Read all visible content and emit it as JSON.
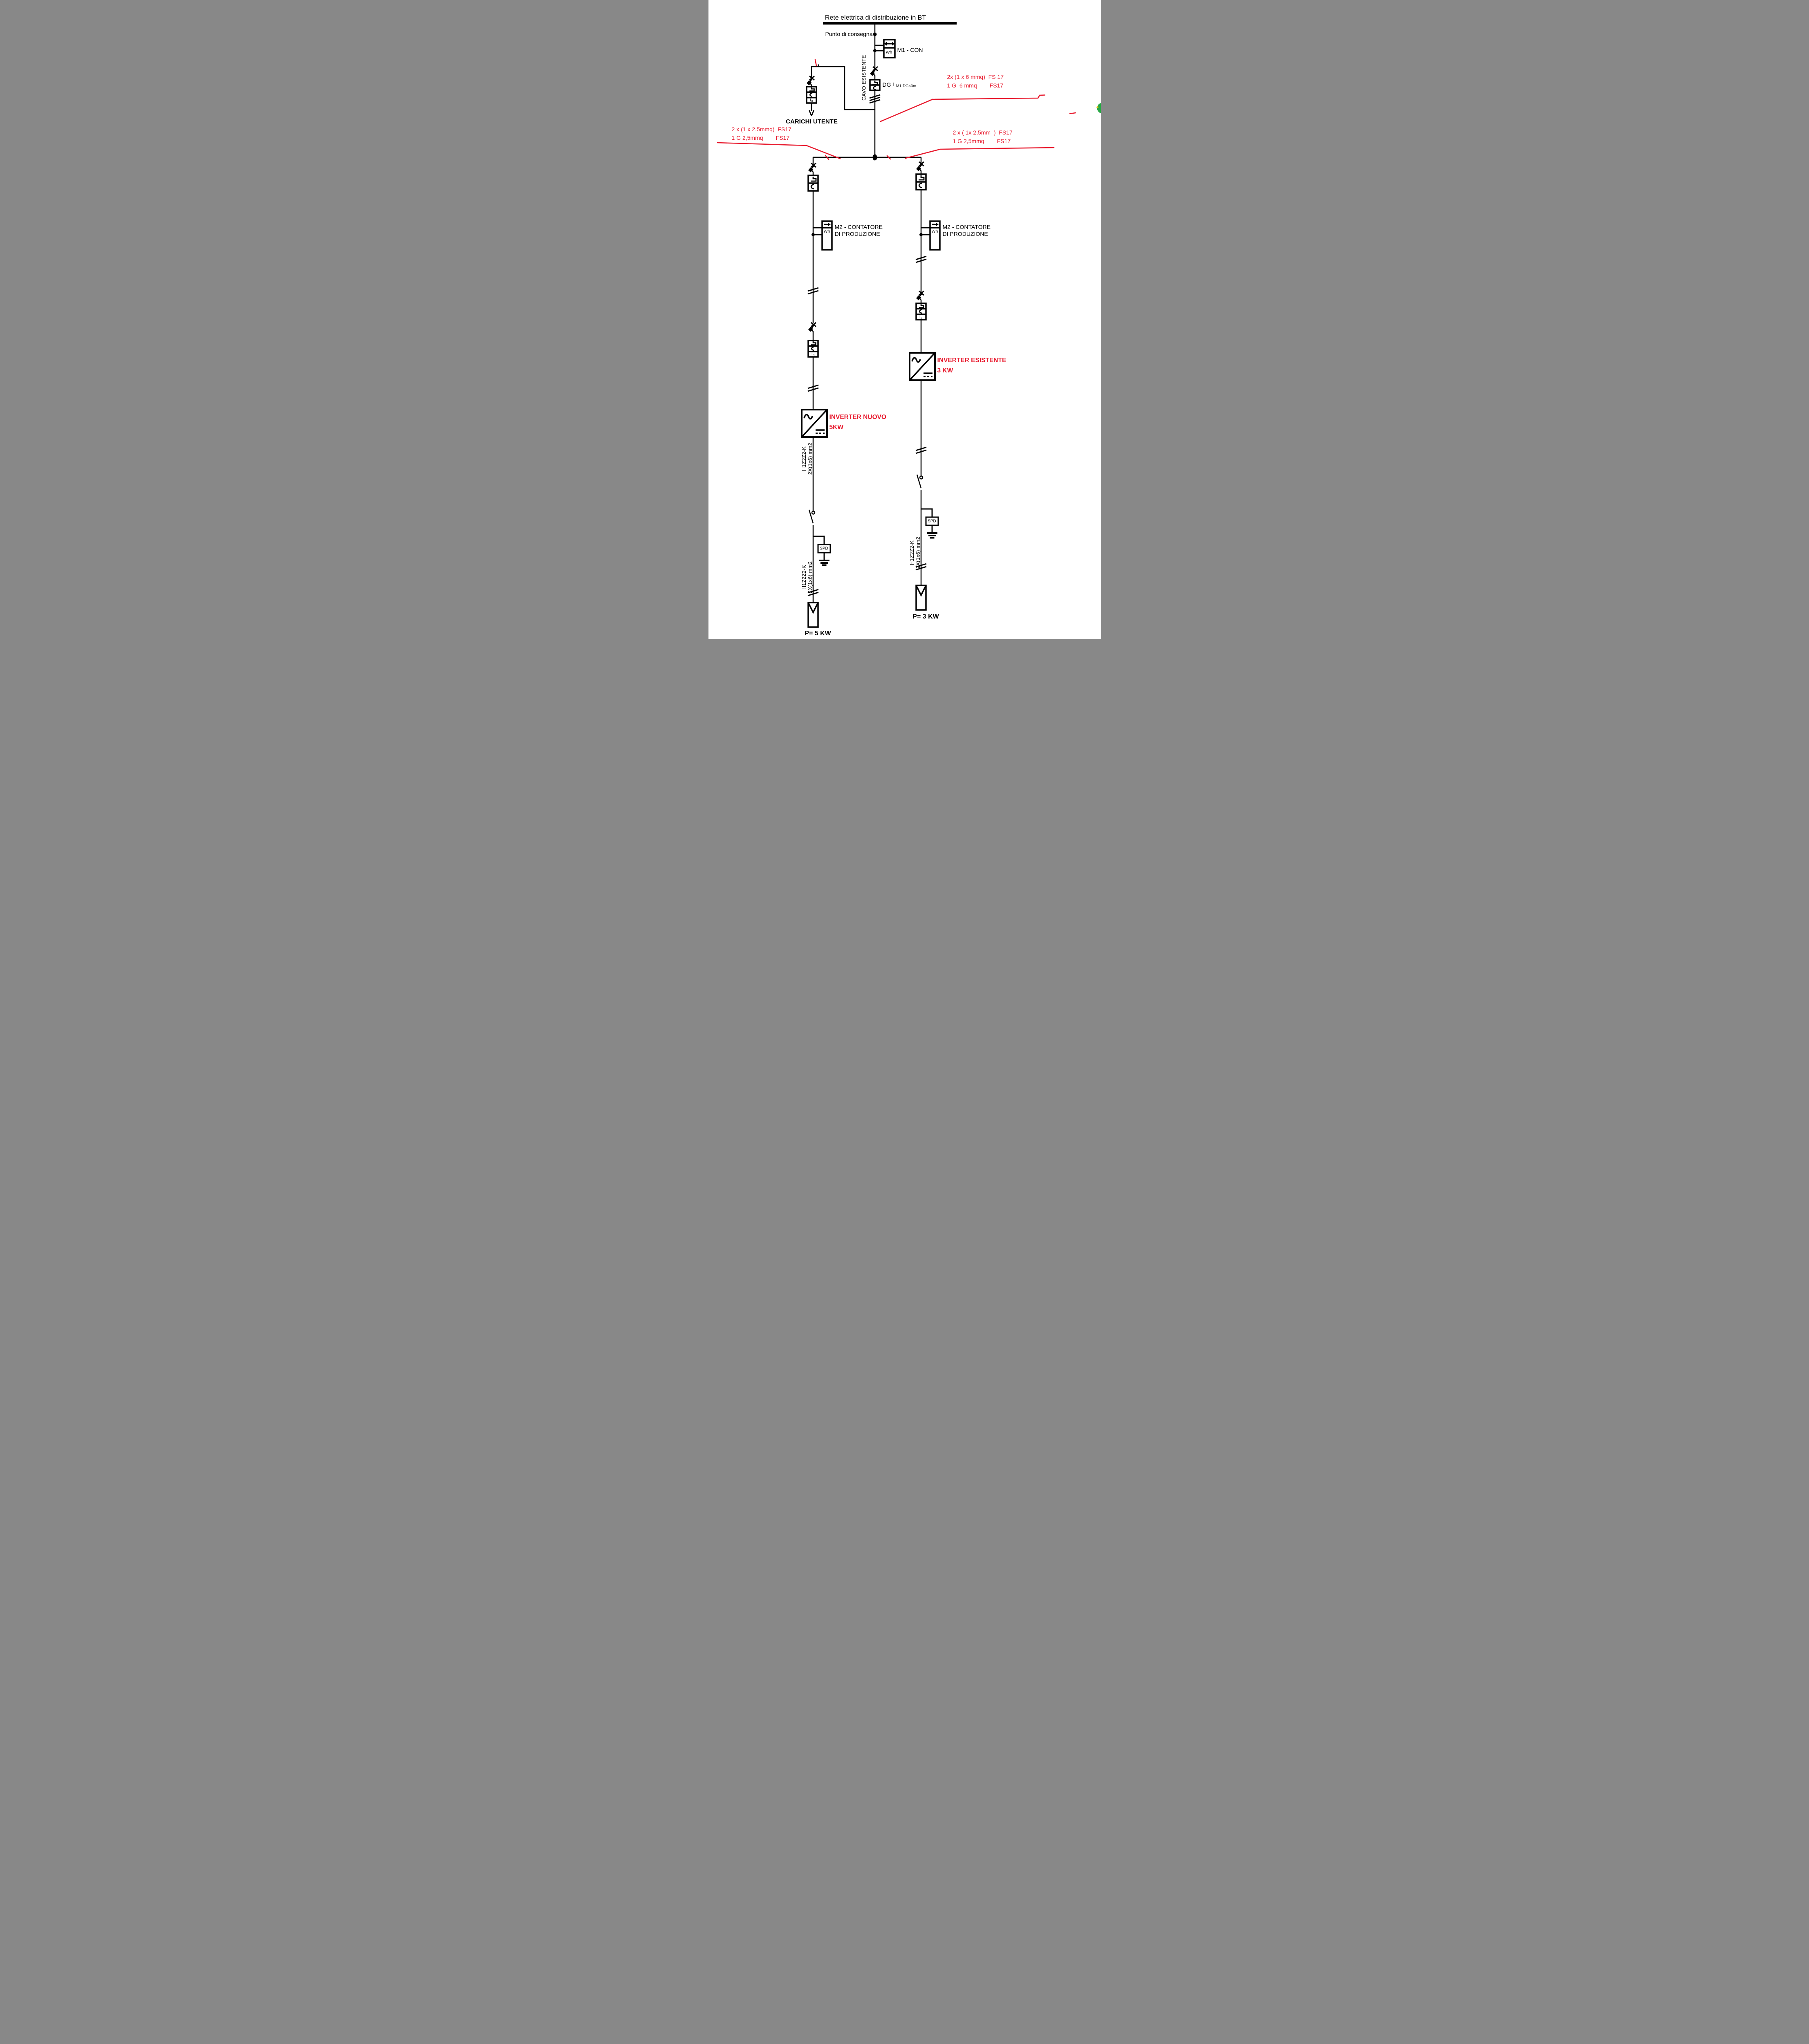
{
  "page": {
    "background": "#ffffff",
    "line_color": "#000000",
    "annotation_color": "#e8192d"
  },
  "grid": {
    "title": "Rete elettrica di distribuzione in BT"
  },
  "delivery": {
    "label": "Punto di consegna"
  },
  "m1": {
    "name": "M1 - CON",
    "unit": "Wh"
  },
  "existing_cable_label": "CAVO ESISTENTE",
  "dg": {
    "label": "DG",
    "len_main": "L",
    "len_sub": "M1-DG<3m"
  },
  "user_loads": {
    "label": "CARICHI UTENTE",
    "breaker_i": "I",
    "breaker_d": "d"
  },
  "annotations": {
    "top_right_1": "2x (1 x 6 mmq)  FS 17",
    "top_right_2": "1 G  6 mmq        FS17",
    "left_1": "2 x (1 x 2,5mmq)  FS17",
    "left_2": "1 G 2,5mmq        FS17",
    "right_1": "2 x ( 1x 2,5mm  )  FS17",
    "right_2": "1 G 2,5mmq        FS17"
  },
  "left_branch": {
    "meter_line1": "M2 - CONTATORE",
    "meter_line2": "DI PRODUZIONE",
    "meter_unit": "Wh",
    "breaker_i": "I",
    "breaker_d": "d",
    "inverter_line1": "INVERTER NUOVO",
    "inverter_line2": "5KW",
    "cable_upper_1": "H1Z2Z2-K",
    "cable_upper_2": "2X(1x6) mm2",
    "spd": "SPD",
    "cable_lower_1": "H1Z2Z2-K",
    "cable_lower_2": "2X(1x6) mm2",
    "pv_power": "P= 5 KW"
  },
  "right_branch": {
    "meter_line1": "M2 - CONTATORE",
    "meter_line2": "DI PRODUZIONE",
    "meter_unit": "Wh",
    "breaker_i": "I",
    "breaker_d": "d",
    "inverter_line1": "INVERTER ESISTENTE",
    "inverter_line2": "3 KW",
    "spd": "SPD",
    "cable_1": "H1Z2Z2-K",
    "cable_2": "2X(1x6) mm2",
    "pv_power": "P= 3 KW"
  }
}
